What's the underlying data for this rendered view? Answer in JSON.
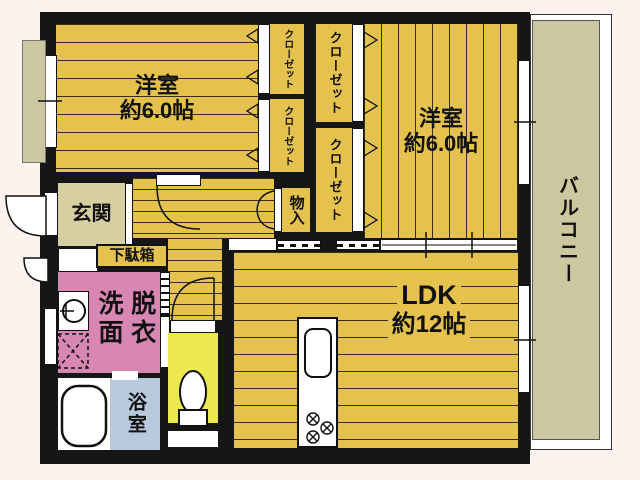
{
  "floorplan": {
    "bedroom1": {
      "label": "洋室",
      "size": "約6.0帖"
    },
    "bedroom2": {
      "label": "洋室",
      "size": "約6.0帖"
    },
    "ldk": {
      "label": "LDK",
      "size": "約12帖"
    },
    "entrance": {
      "label": "玄関"
    },
    "shoe_box": {
      "label": "下駄箱"
    },
    "storage": {
      "label": "物入"
    },
    "closet": {
      "label": "クローゼット"
    },
    "washroom": {
      "col_left": "洗面",
      "col_right": "脱衣"
    },
    "bathroom": {
      "label": "浴室"
    },
    "balcony": {
      "label": "バルコニー"
    },
    "colors": {
      "floor": "#e5c24d",
      "wall": "#161616",
      "entrance": "#d5cfa2",
      "balcony": "#ccc79e",
      "washroom": "#d887b2",
      "bathroom": "#b7c9dc",
      "toilet": "#ebe94f",
      "background": "#fdf2ee",
      "fixture": "#ffffff"
    }
  }
}
